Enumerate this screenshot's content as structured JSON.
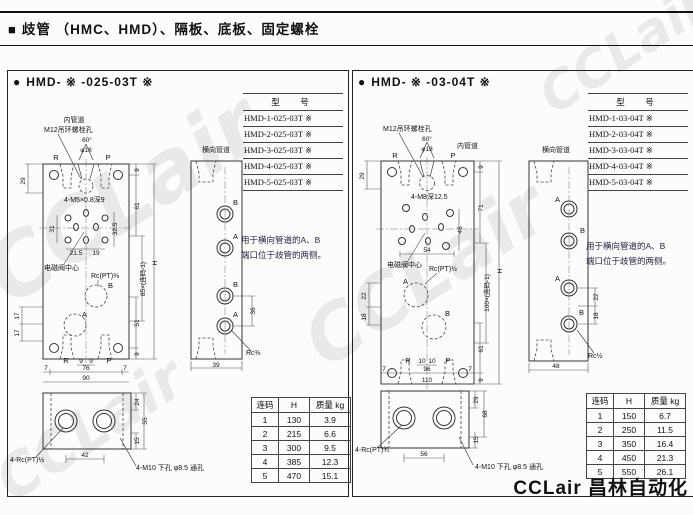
{
  "page": {
    "marker": "■",
    "title": "歧管 （HMC、HMD）、隔板、底板、固定螺栓",
    "footer": "CCLair 昌林自动化",
    "watermark": "CCLair"
  },
  "panels": [
    {
      "bullet": "●",
      "title": "HMD- ※ -025-03T ※",
      "model_table": {
        "header": "型　号",
        "rows": [
          "HMD-1-025-03T ※",
          "HMD-2-025-03T ※",
          "HMD-3-025-03T ※",
          "HMD-4-025-03T ※",
          "HMD-5-025-03T ※"
        ]
      },
      "labels": {
        "inner_pipe": "内管道",
        "m12": "M12吊环螺栓孔",
        "angle": "60°",
        "dia": "φ18",
        "r": "R",
        "p": "P",
        "cross_pipe": "横向管道",
        "tap": "4-M5×0.8深9",
        "solenoid": "电磁阀中心",
        "rc_center": "Rc(PT)⅜",
        "a": "A",
        "b": "B",
        "rc_side": "Rc⅜",
        "rc_bottom": "4-Rc(PT)½",
        "m10": "4-M10 下孔 φ8.5 通孔"
      },
      "dims": {
        "d29": "29",
        "d9t": "9",
        "d61": "61",
        "d31": "31",
        "d32_5": "32.5",
        "d21_5": "21.5",
        "d19": "19",
        "d17a": "17",
        "d17b": "17",
        "pitch": "85×(连码-1)",
        "h": "H",
        "d51": "51",
        "d9b": "9",
        "bR": "R",
        "b9a": "9",
        "b9b": "9",
        "bP": "P",
        "b7a": "7",
        "b76": "76",
        "b7b": "7",
        "b90": "90",
        "s36": "36",
        "s39": "39",
        "v24": "24",
        "v55": "55",
        "v15": "15",
        "v42": "42"
      },
      "note": {
        "line1": "用于横向管道的A、B",
        "line2": "端口位于歧管的两侧。"
      },
      "spec_table": {
        "headers": [
          "连码",
          "H",
          "质量 kg"
        ],
        "rows": [
          [
            "1",
            "130",
            "3.9"
          ],
          [
            "2",
            "215",
            "6.6"
          ],
          [
            "3",
            "300",
            "9.5"
          ],
          [
            "4",
            "385",
            "12.3"
          ],
          [
            "5",
            "470",
            "15.1"
          ]
        ]
      }
    },
    {
      "bullet": "●",
      "title": "HMD- ※ -03-04T ※",
      "model_table": {
        "header": "型　号",
        "rows": [
          "HMD-1-03-04T ※",
          "HMD-2-03-04T ※",
          "HMD-3-03-04T ※",
          "HMD-4-03-04T ※",
          "HMD-5-03-04T ※"
        ]
      },
      "labels": {
        "inner_pipe": "内管道",
        "m12": "M12吊环螺栓孔",
        "angle": "60°",
        "dia": "φ18",
        "r": "R",
        "p": "P",
        "cross_pipe": "横向管道",
        "tap": "4-M8深12.5",
        "solenoid": "电磁阀中心",
        "rc_center": "Rc(PT)½",
        "a": "A",
        "b": "B",
        "rc_side": "Rc½",
        "rc_bottom": "4-Rc(PT)¾",
        "m10": "4-M10 下孔 φ8.5 通孔"
      },
      "dims": {
        "d29": "29",
        "d9t": "9",
        "d71": "71",
        "d46": "46",
        "d54": "54",
        "d22": "22",
        "d18": "18",
        "pitch": "100×(连码-1)",
        "h": "H",
        "d61": "61",
        "d9b": "9",
        "bR": "R",
        "b10a": "10",
        "b10b": "10",
        "bP": "P",
        "b7a": "7",
        "b96": "96",
        "b7b": "7",
        "b110": "110",
        "s22": "22",
        "s18": "18",
        "s48": "48",
        "v29": "29",
        "v68": "68",
        "v15": "15",
        "v56": "56"
      },
      "note": {
        "line1": "用于横向管道的A、B",
        "line2": "端口位于歧管的两侧。"
      },
      "spec_table": {
        "headers": [
          "连码",
          "H",
          "质量 kg"
        ],
        "rows": [
          [
            "1",
            "150",
            "6.7"
          ],
          [
            "2",
            "250",
            "11.5"
          ],
          [
            "3",
            "350",
            "16.4"
          ],
          [
            "4",
            "450",
            "21.3"
          ],
          [
            "5",
            "550",
            "26.1"
          ]
        ]
      }
    }
  ]
}
